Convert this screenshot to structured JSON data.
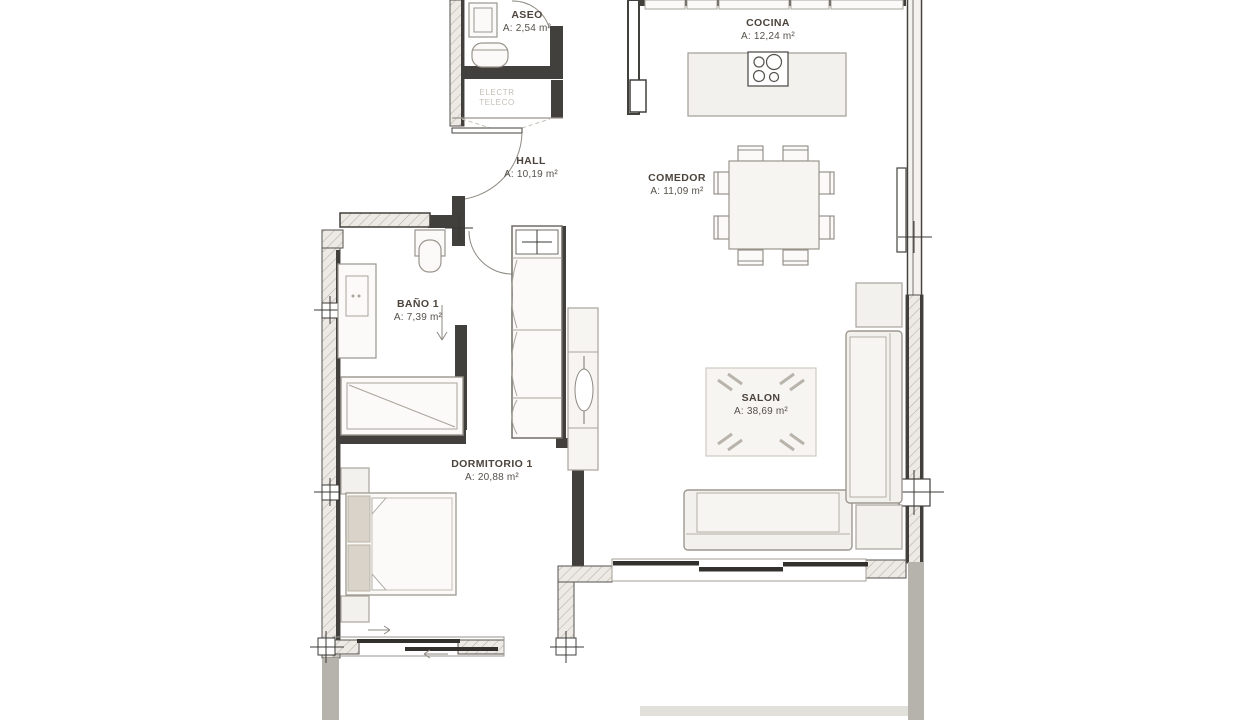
{
  "rooms": [
    {
      "key": "aseo",
      "name": "ASEO",
      "area": "A: 2,54 m²"
    },
    {
      "key": "cocina",
      "name": "COCINA",
      "area": "A: 12,24 m²"
    },
    {
      "key": "hall",
      "name": "HALL",
      "area": "A: 10,19 m²"
    },
    {
      "key": "comedor",
      "name": "COMEDOR",
      "area": "A: 11,09 m²"
    },
    {
      "key": "bano1",
      "name": "BAÑO 1",
      "area": "A: 7,39 m²"
    },
    {
      "key": "salon",
      "name": "SALON",
      "area": "A: 38,69 m²"
    },
    {
      "key": "dormitorio1",
      "name": "DORMITORIO 1",
      "area": "A: 20,88 m²"
    }
  ],
  "utility_closet": {
    "line1": "ELECTR",
    "line2": "TELECO"
  },
  "colors": {
    "wall": "#42403c",
    "hatch_fill": "#edeae5",
    "hatch_line": "#b9b4ac",
    "terrace_wall": "#b6b2ac",
    "furniture_fill": "#f3f1ed",
    "furniture_stroke": "#a9a49c",
    "label_text": "#4c443c",
    "faint_text": "#c4bfb6",
    "background": "#ffffff"
  }
}
